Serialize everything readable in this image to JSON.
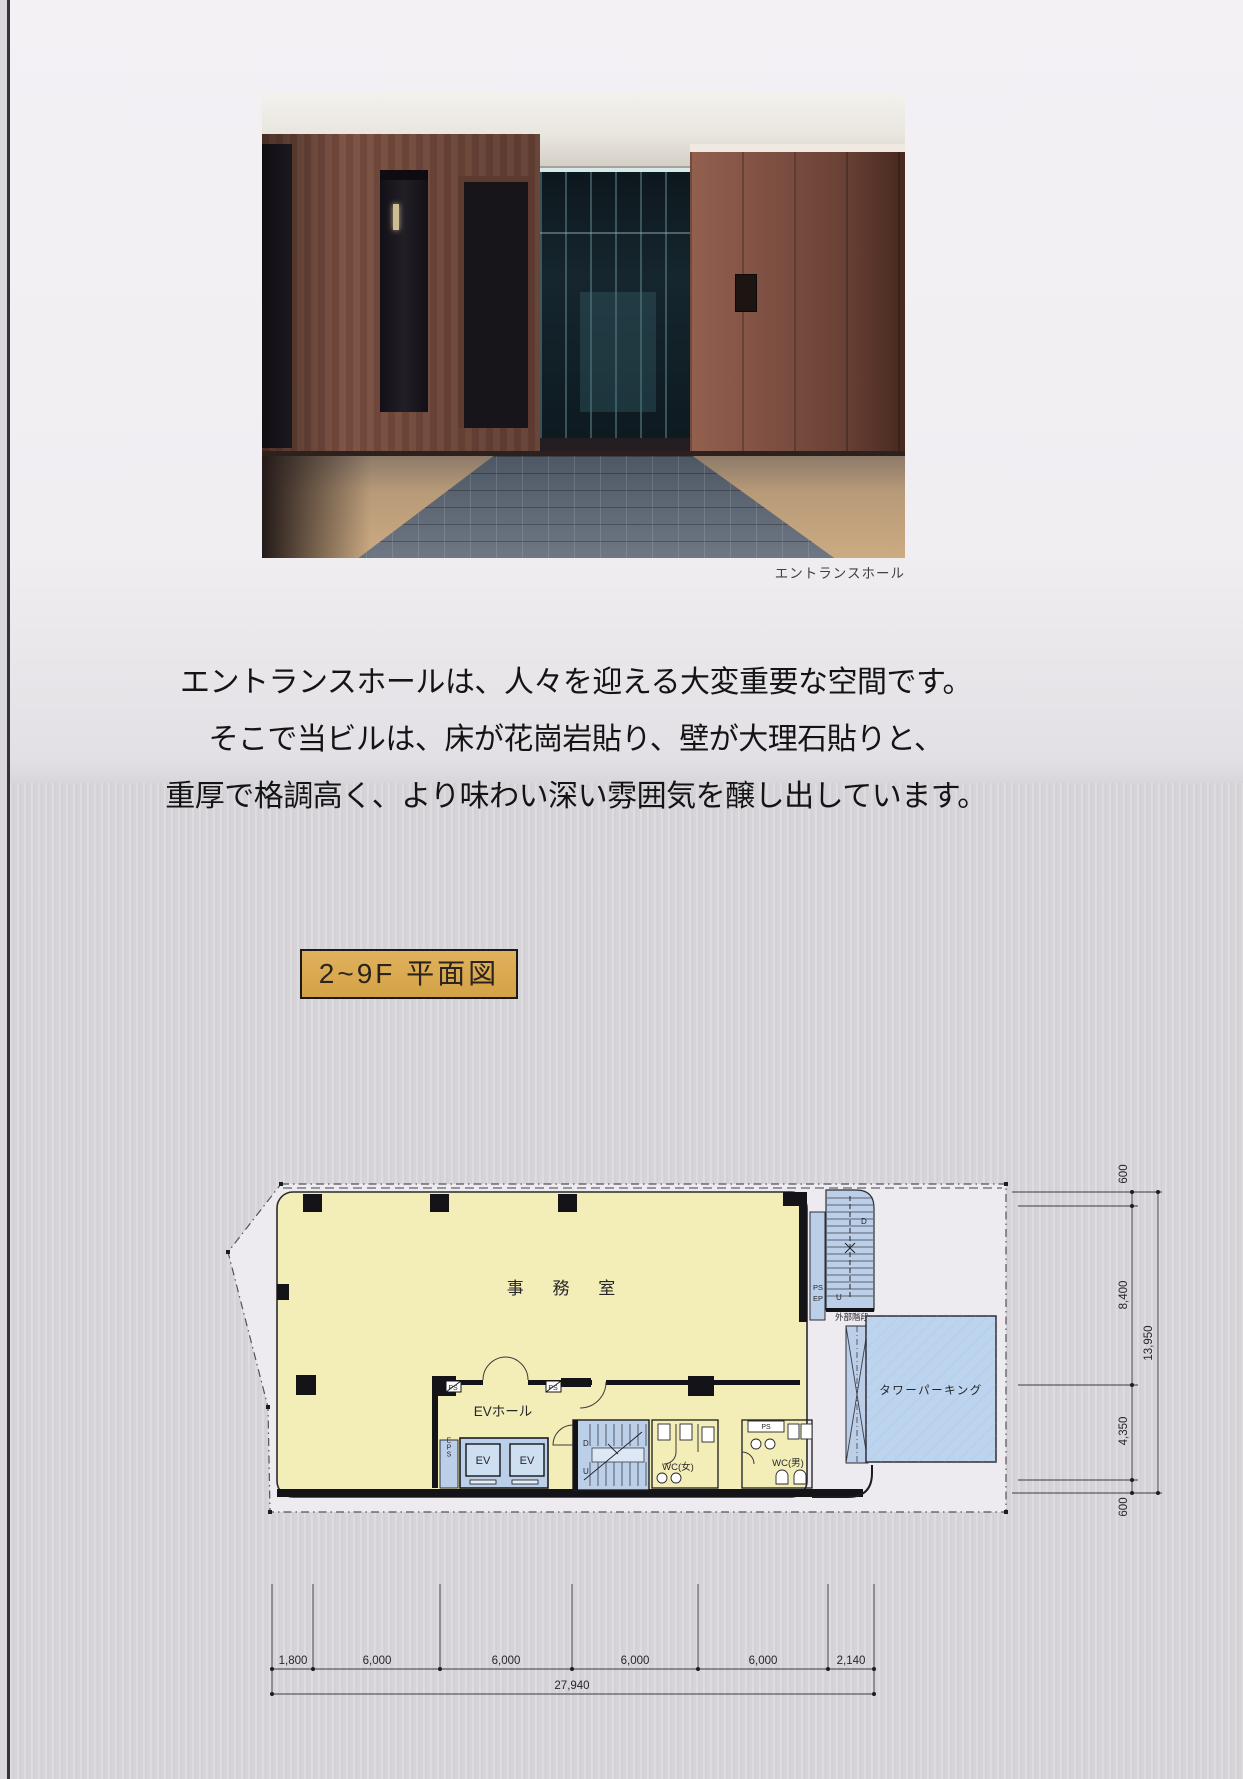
{
  "page": {
    "photo_caption": "エントランスホール",
    "intro_line1": "エントランスホールは、人々を迎える大変重要な空間です。",
    "intro_line2": "そこで当ビルは、床が花崗岩貼り、壁が大理石貼りと、",
    "intro_line3": "重厚で格調高く、より味わい深い雰囲気を醸し出しています。",
    "plan_title": "2~9F 平面図"
  },
  "plan": {
    "office": "事 務 室",
    "ev_hall": "EVホール",
    "ev_left": "EV",
    "ev_right": "EV",
    "eps": "EPS",
    "ps_top_left": "PS",
    "ps_top_right": "PS",
    "ps_wc_men": "PS",
    "shaft_ps": "PS",
    "shaft_ep": "EP",
    "wc_women": "WC(女)",
    "wc_men": "WC(男)",
    "outer_stair": "外部階段",
    "tower_parking": "タワーパーキング",
    "inner_stair_d": "D",
    "inner_stair_u": "U",
    "outer_stair_d": "D",
    "outer_stair_u": "U"
  },
  "dimensions": {
    "bottom_segments": [
      "1,800",
      "6,000",
      "6,000",
      "6,000",
      "6,000",
      "2,140"
    ],
    "bottom_total": "27,940",
    "right_top": "600",
    "right_upper": "8,400",
    "right_lower": "4,350",
    "right_bottom": "600",
    "right_total": "13,950"
  },
  "colors": {
    "plan_yellow": "#f3eeb7",
    "plan_blue": "#bccfe9",
    "parking_blue": "#bdd4ee",
    "label_gold": "#d9a94e",
    "page_white": "#f1eff2",
    "page_gray": "#d7d4d9"
  }
}
